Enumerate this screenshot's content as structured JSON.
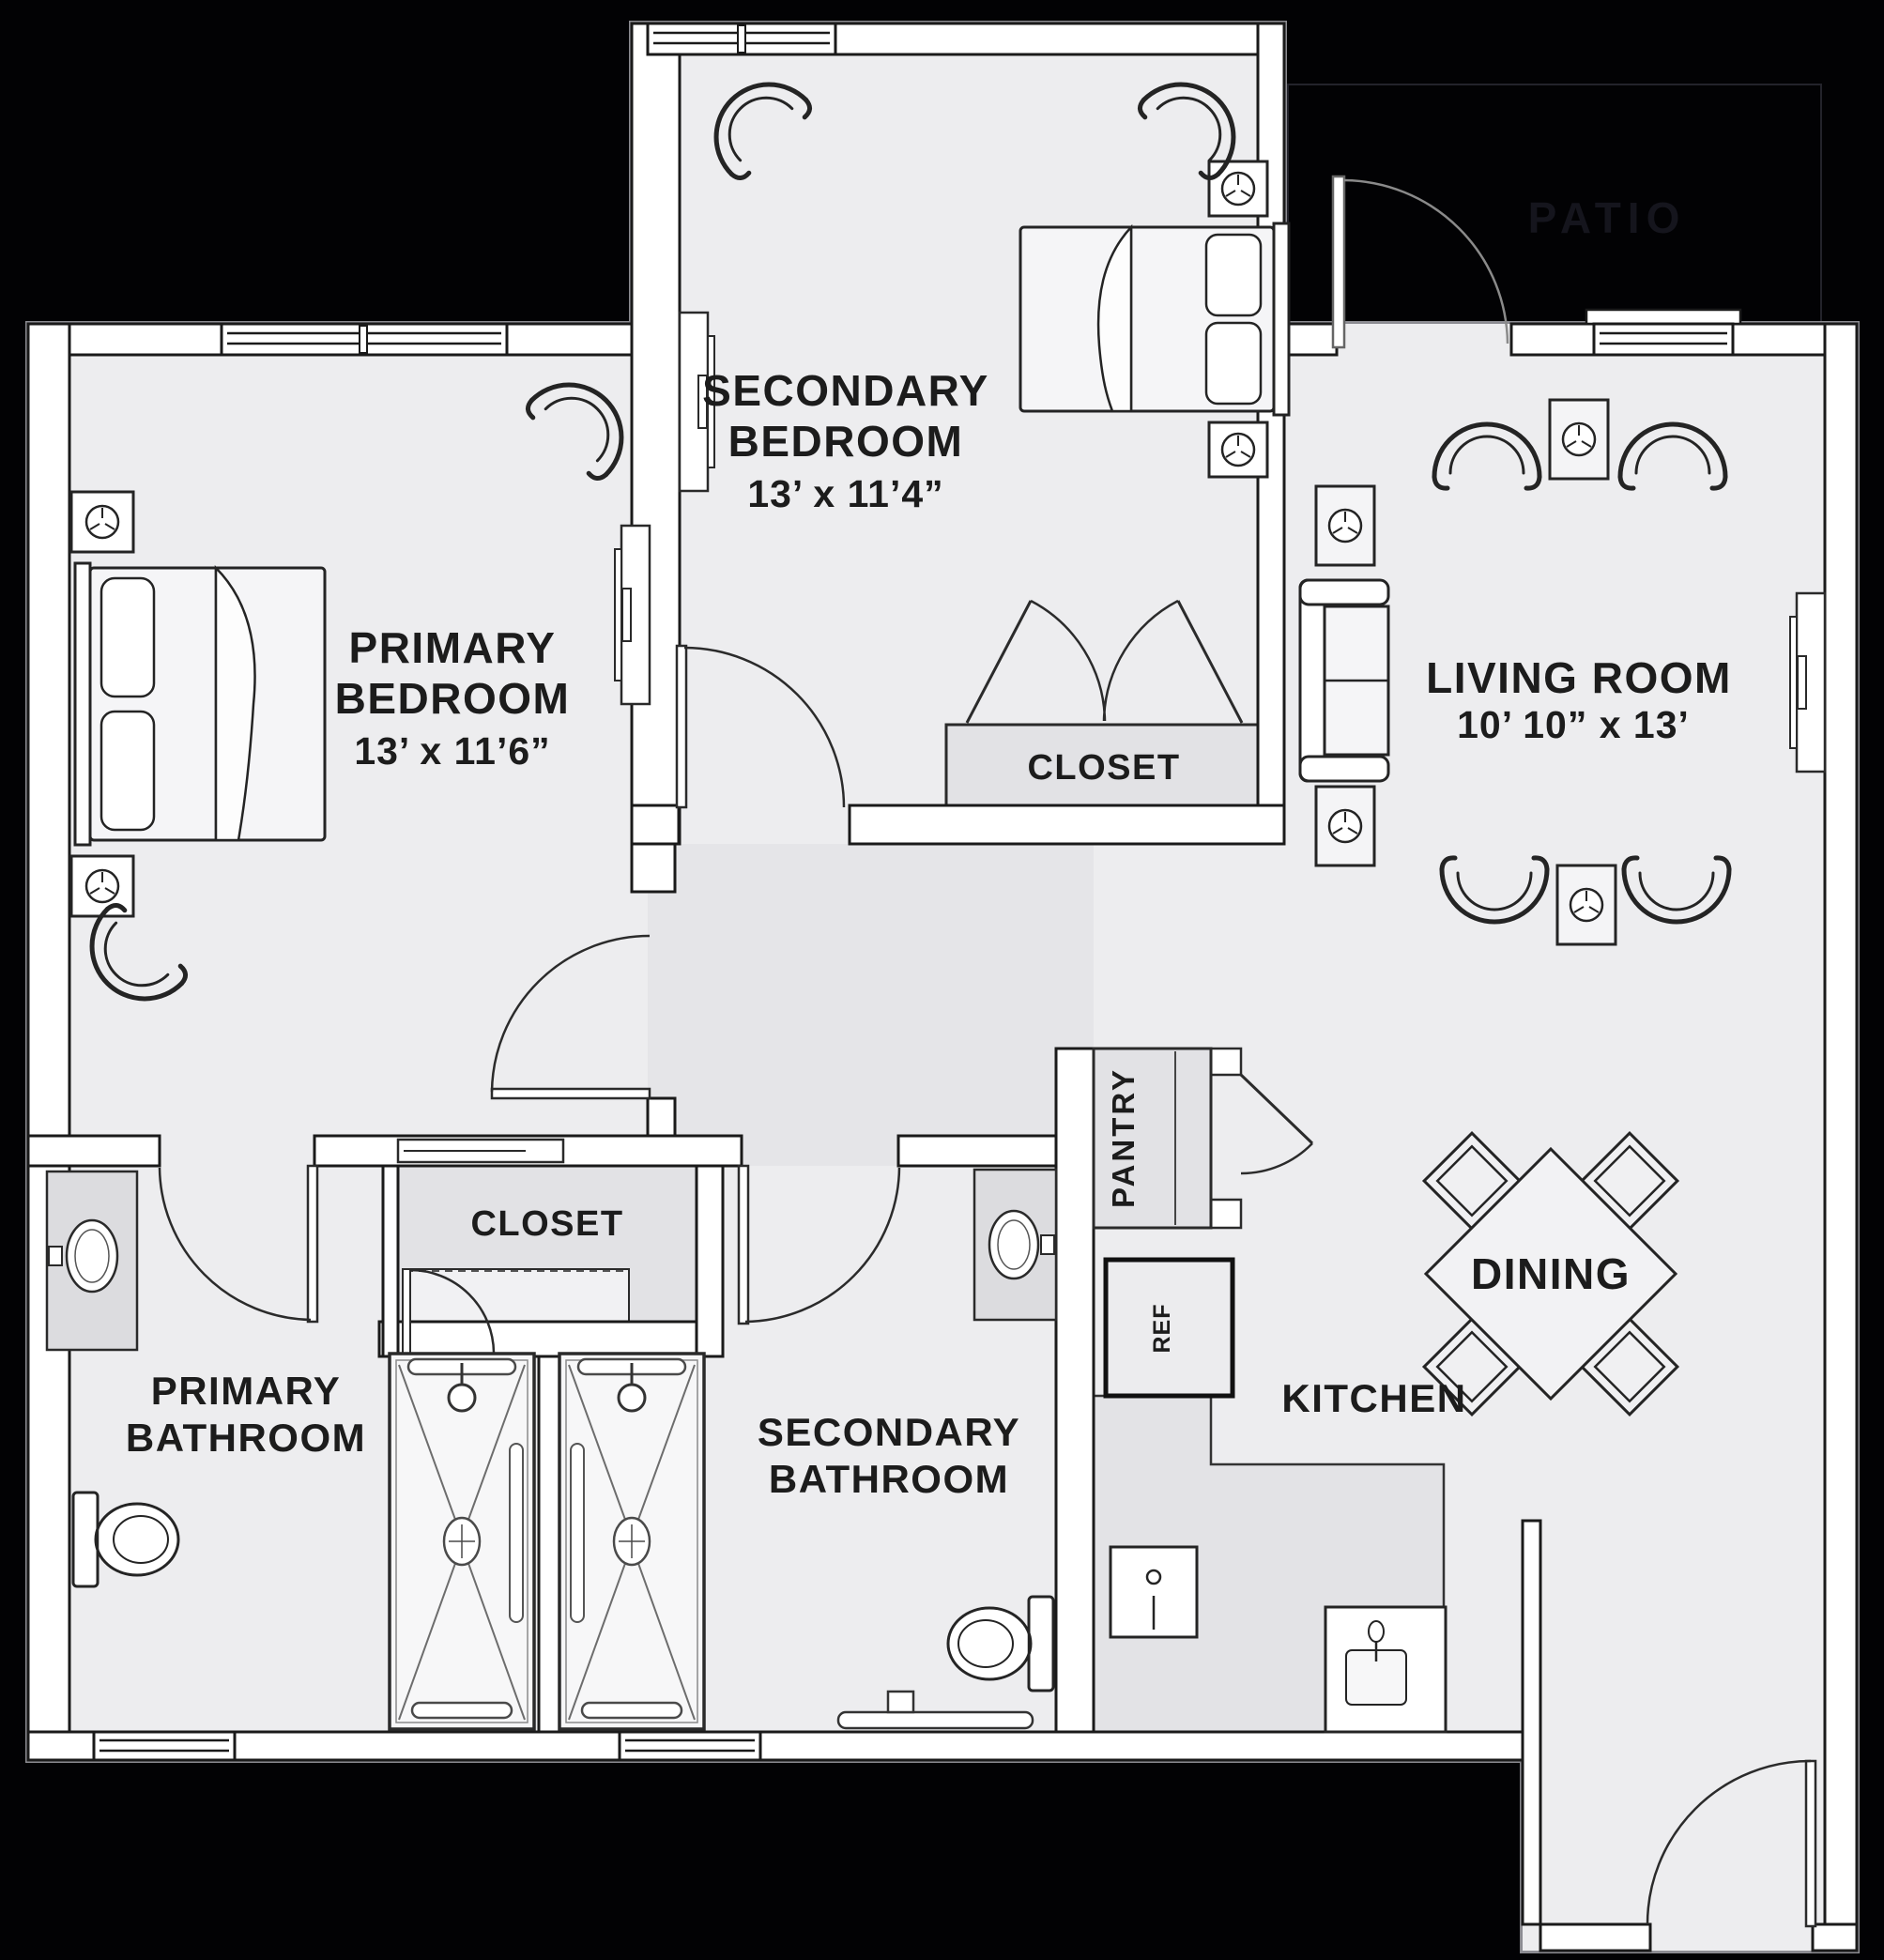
{
  "plan": {
    "title": "Two bedroom two bathroom apartment floor plan",
    "colors": {
      "background": "#020204",
      "floor": "#ededef",
      "hall_floor": "#e5e5e8",
      "wall_fill": "#ffffff",
      "wall_line": "#1a1a1a",
      "closet_fill": "#e2e2e5",
      "patio_text": "#15151d"
    },
    "rooms": {
      "primary_bedroom": {
        "name_line1": "PRIMARY",
        "name_line2": "BEDROOM",
        "dimensions": "13’ x 11’6”"
      },
      "secondary_bedroom": {
        "name_line1": "SECONDARY",
        "name_line2": "BEDROOM",
        "dimensions": "13’ x 11’4”"
      },
      "living_room": {
        "name": "LIVING ROOM",
        "dimensions": "10’ 10” x 13’"
      },
      "primary_bathroom": {
        "name_line1": "PRIMARY",
        "name_line2": "BATHROOM"
      },
      "secondary_bathroom": {
        "name_line1": "SECONDARY",
        "name_line2": "BATHROOM"
      },
      "kitchen": {
        "name": "KITCHEN"
      },
      "dining": {
        "name": "DINING"
      },
      "pantry": {
        "name": "PANTRY"
      },
      "refrigerator": {
        "label": "REF"
      },
      "closet_primary": {
        "name": "CLOSET"
      },
      "closet_secondary": {
        "name": "CLOSET"
      },
      "patio": {
        "name": "PATIO"
      }
    }
  }
}
